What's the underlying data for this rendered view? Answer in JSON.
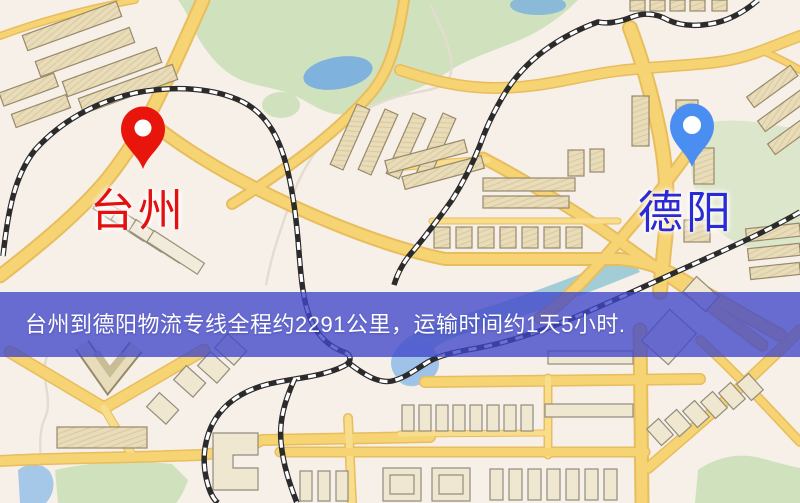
{
  "map": {
    "banner": {
      "text": "台州到德阳物流专线全程约2291公里，运输时间约1天5小时.",
      "bg_color": "rgba(64,70,202,0.78)",
      "text_color": "#ffffff"
    },
    "origin": {
      "label": "台州",
      "label_color": "#e60f10",
      "pin_color": "#e8150d"
    },
    "destination": {
      "label": "德阳",
      "label_color": "#2a2ad6",
      "pin_color": "#4a8ef2"
    },
    "palette": {
      "background": "#f7f0e9",
      "road_yellow": "#f6d373",
      "green_area": "#cfe2bd",
      "water_blue": "#7fb2dd",
      "building_tan": "#e9dcb8",
      "railway_black": "#2b2b2b"
    }
  }
}
